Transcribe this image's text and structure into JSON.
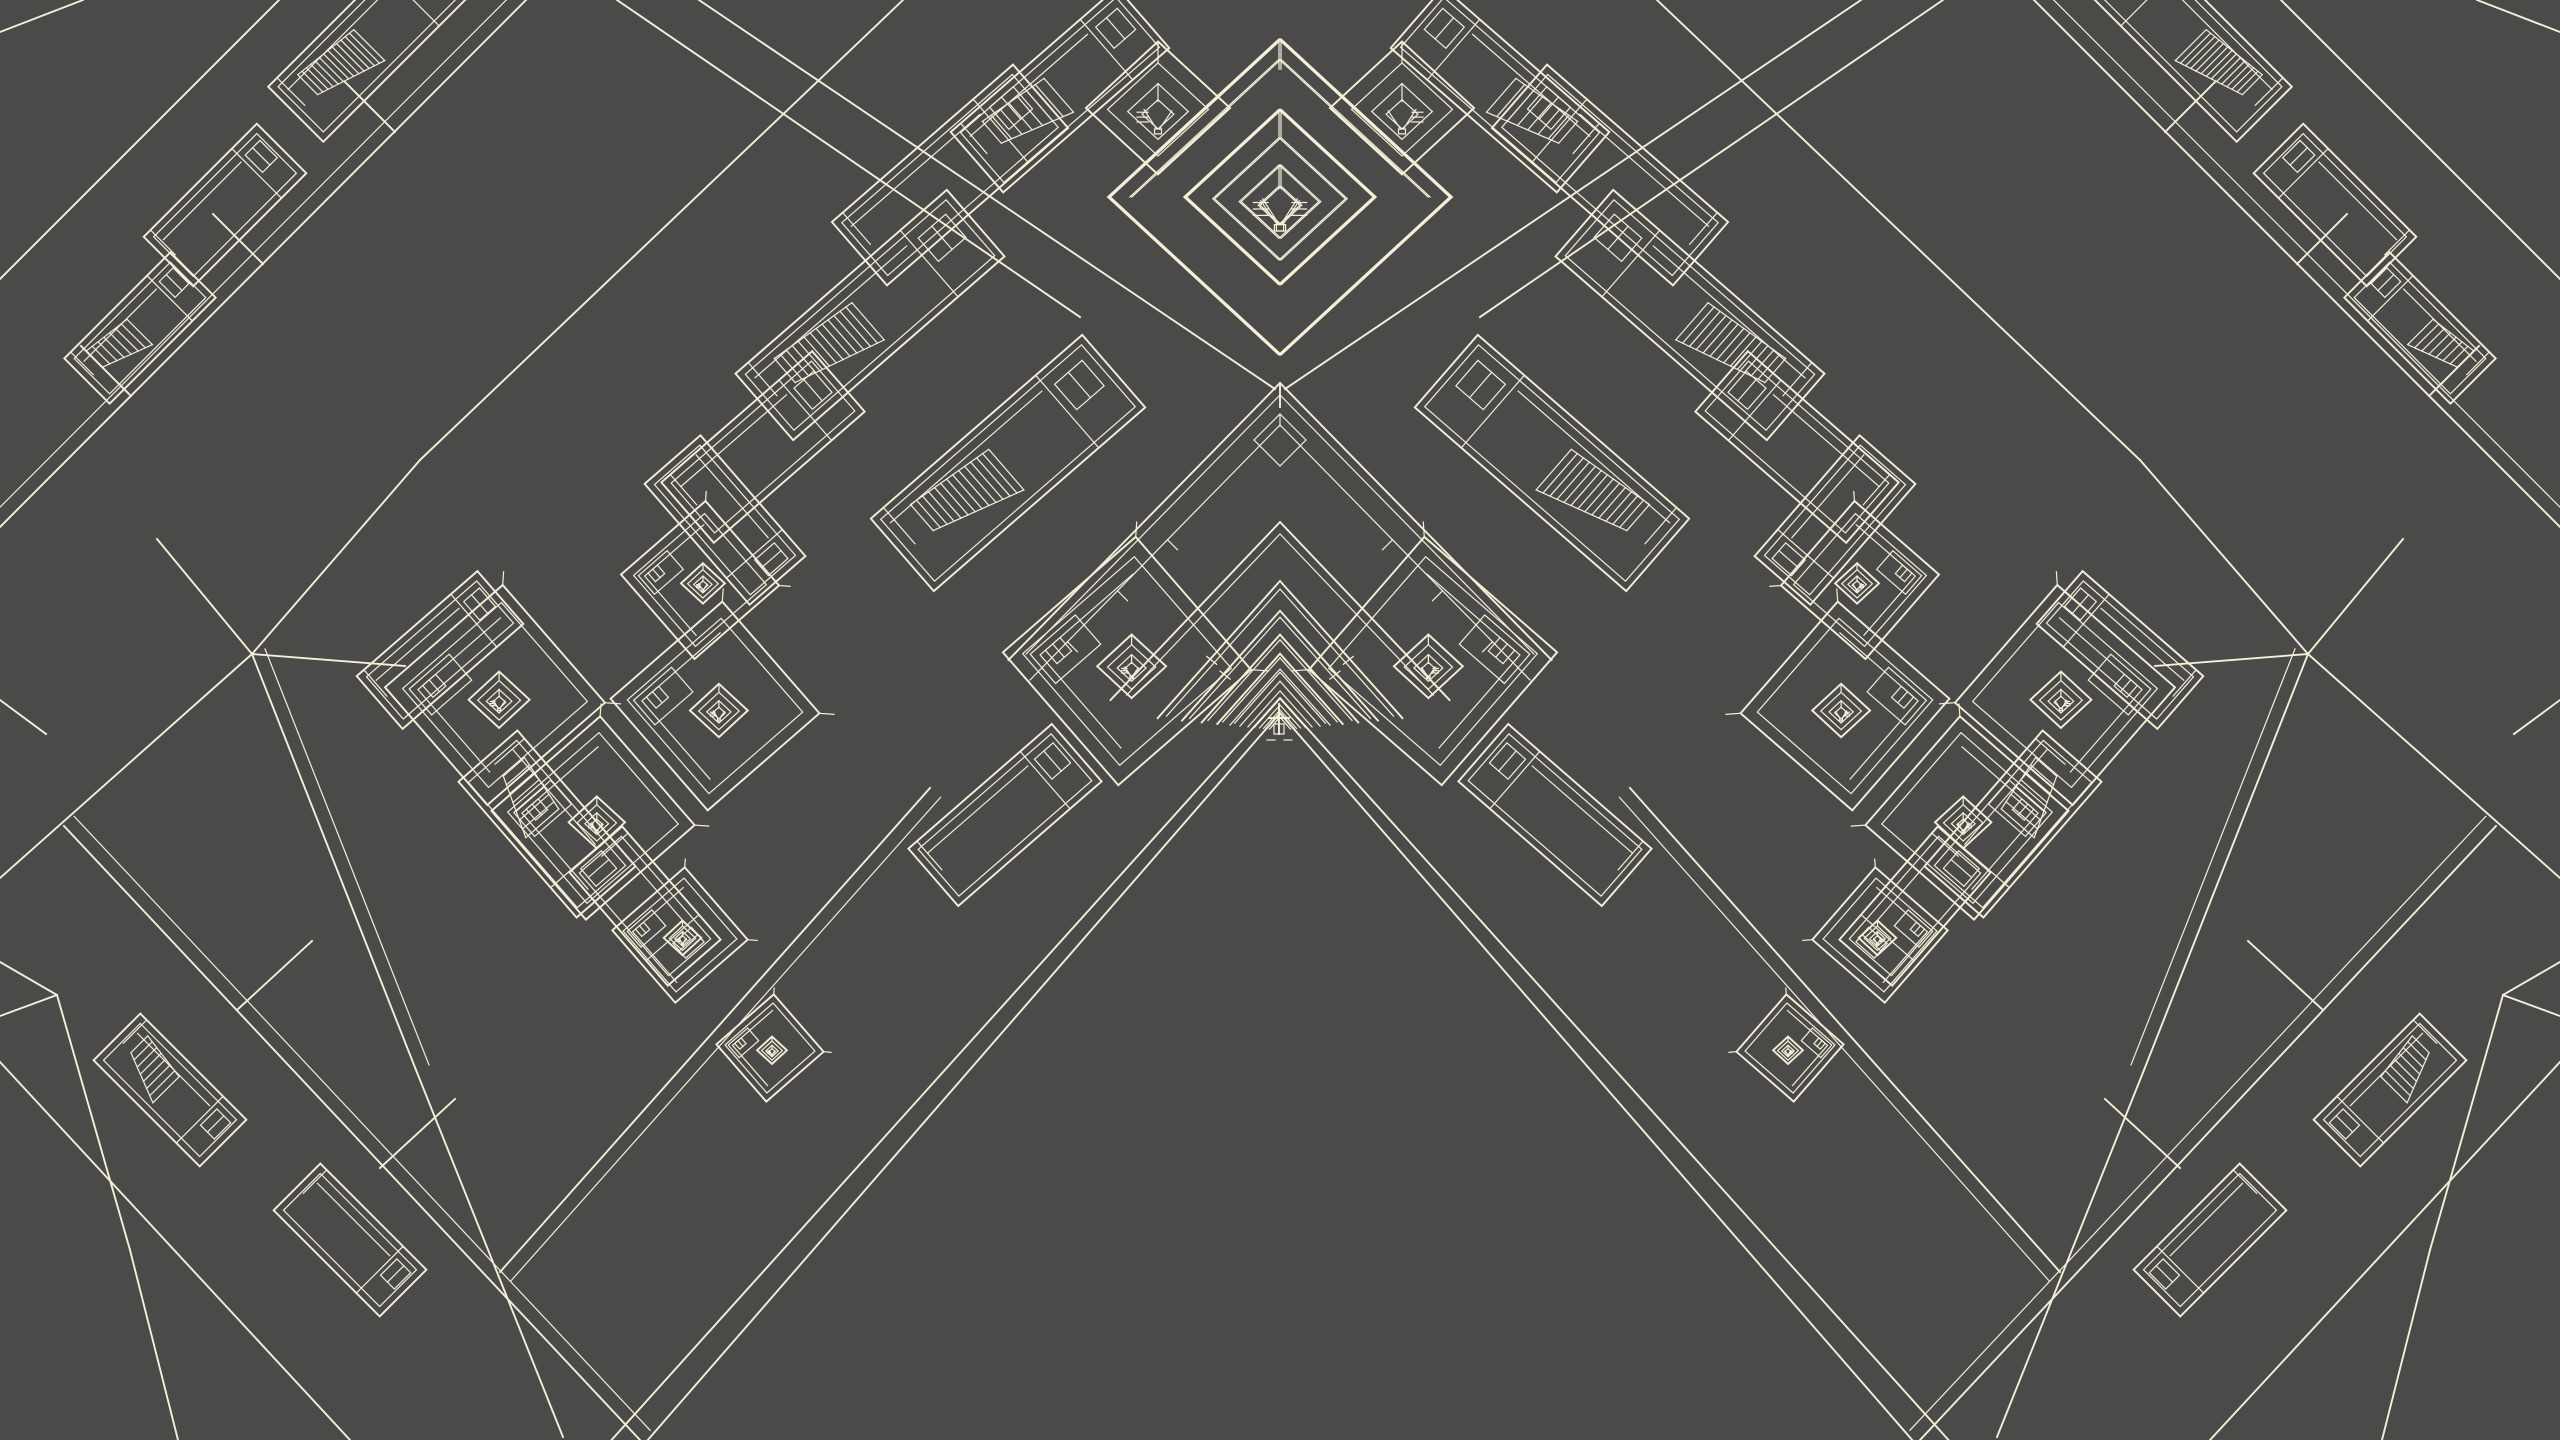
{
  "viewport": {
    "width": 2560,
    "height": 1440
  },
  "colors": {
    "background": "#4a4a48",
    "line": "#f5efd8"
  },
  "axes": {
    "u_deg": -41,
    "v_deg": 49,
    "mirror_x": 1280
  },
  "center": {
    "cx": 1280,
    "vanish_y": 730,
    "chevron1": {
      "apex_y": 383,
      "slope": 1.02,
      "end_y": 660,
      "ridge_len": 24,
      "inner_offset": 42,
      "sub_diamond": {
        "y": 440,
        "r": 26
      }
    },
    "chevron2": {
      "apex_y": 522,
      "slope": 1.05,
      "end_y": 700
    },
    "recursion": {
      "h0": 149,
      "ratio": 0.8,
      "count": 12,
      "slope": 1.12
    },
    "void": {
      "outer_apex_y": 698,
      "outer_slope": 1.11,
      "inner_apex_y": 713,
      "inner_slope": 1.15,
      "bottom_y": 1440
    },
    "figure": {
      "x": 1279,
      "y": 718,
      "v_top": 704,
      "v_bot": 734,
      "bar_half": 10,
      "dashes_y": 740
    }
  },
  "halls": [
    [
      870,
      315,
      -41,
      280,
      88,
      "dense"
    ],
    [
      763,
      447,
      -41,
      200,
      80,
      "plain"
    ],
    [
      725,
      520,
      49,
      160,
      74,
      "plain"
    ],
    [
      1008,
      463,
      -41,
      280,
      96,
      "dense"
    ],
    [
      950,
      175,
      -41,
      240,
      84,
      "plain"
    ],
    [
      1060,
      90,
      -41,
      220,
      80,
      "stairs"
    ],
    [
      370,
      40,
      -45,
      210,
      78,
      "dense"
    ],
    [
      140,
      328,
      -45,
      150,
      64,
      "stairs"
    ],
    [
      225,
      205,
      -45,
      160,
      70,
      "plain"
    ],
    [
      440,
      650,
      -41,
      160,
      70,
      "plain"
    ],
    [
      547,
      824,
      49,
      180,
      78,
      "stairs"
    ],
    [
      645,
      906,
      49,
      150,
      70,
      "plain"
    ],
    [
      170,
      1090,
      45,
      150,
      66,
      "stairs"
    ],
    [
      350,
      1240,
      45,
      150,
      66,
      "plain"
    ],
    [
      1005,
      815,
      -41,
      190,
      76,
      "plain"
    ]
  ],
  "courts": [
    [
      495,
      695,
      78
    ],
    [
      593,
      818,
      72
    ],
    [
      715,
      706,
      74
    ],
    [
      700,
      580,
      56
    ],
    [
      1127,
      661,
      88
    ],
    [
      680,
      935,
      48
    ],
    [
      770,
      1048,
      38
    ]
  ],
  "pavilions": [
    [
      1158,
      108,
      70,
      0
    ],
    [
      1281,
      197,
      92,
      1
    ]
  ],
  "lines": [
    [
      0,
      527,
      526,
      0,
      1
    ],
    [
      0,
      279,
      279,
      0,
      0
    ],
    [
      0,
      32,
      83,
      0,
      0
    ],
    [
      131,
      396,
      81,
      346,
      0
    ],
    [
      263,
      264,
      213,
      214,
      0
    ],
    [
      395,
      132,
      345,
      82,
      0
    ],
    [
      699,
      0,
      1275,
      389,
      0
    ],
    [
      617,
      0,
      1080,
      317,
      0
    ],
    [
      252,
      654,
      420,
      460,
      0
    ],
    [
      420,
      460,
      903,
      0,
      0
    ],
    [
      252,
      654,
      405,
      666,
      0
    ],
    [
      252,
      654,
      416,
      1070,
      1
    ],
    [
      416,
      1070,
      563,
      1437,
      0
    ],
    [
      252,
      654,
      157,
      539,
      0
    ],
    [
      252,
      654,
      0,
      878,
      0
    ],
    [
      930,
      788,
      500,
      1272,
      1
    ],
    [
      64,
      826,
      640,
      1440,
      1
    ],
    [
      0,
      1062,
      350,
      1440,
      0
    ],
    [
      57,
      995,
      0,
      962,
      0
    ],
    [
      57,
      995,
      0,
      1016,
      0
    ],
    [
      57,
      995,
      130,
      1250,
      0
    ],
    [
      130,
      1250,
      178,
      1440,
      0
    ],
    [
      0,
      700,
      46,
      734,
      0
    ],
    [
      237,
      1010,
      312,
      941,
      0
    ],
    [
      380,
      1168,
      455,
      1099,
      0
    ]
  ]
}
